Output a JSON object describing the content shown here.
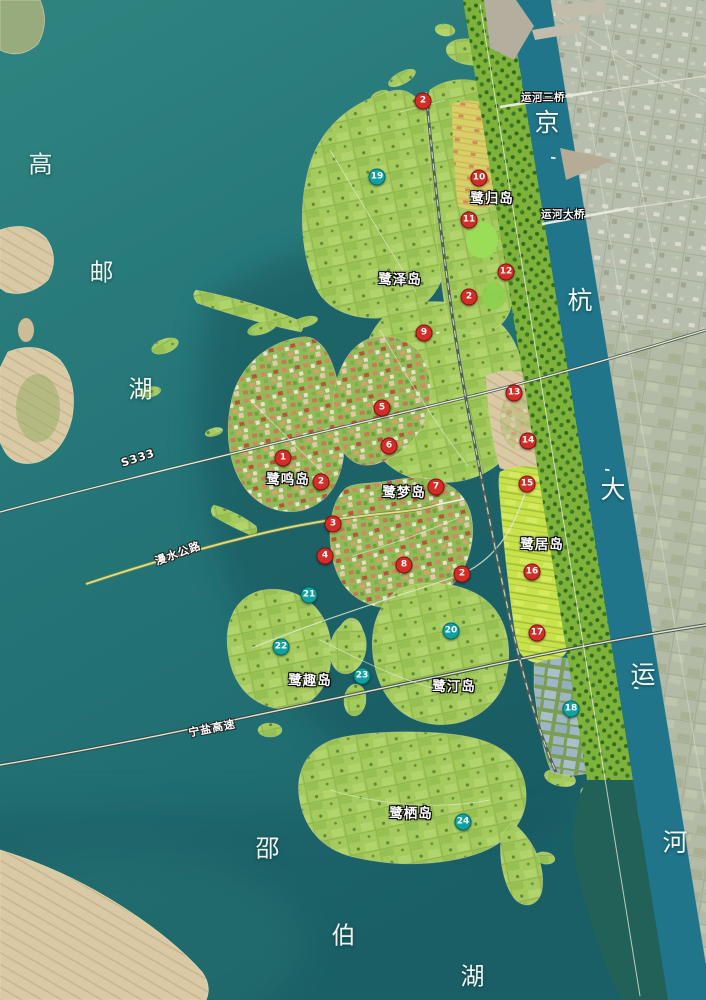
{
  "colors": {
    "lake": "#27787a",
    "lake_deep": "#14525a",
    "canal": "#20758a",
    "island_green": "#a5cb5f",
    "belt_green": "#7fb23b",
    "city_land": "#b8bead",
    "farm_land": "#b3bba6",
    "tan_flat": "#d9c9a4",
    "bright_fields": "#c9e24b",
    "marker_red": "#d22d26",
    "marker_teal": "#11a1a1",
    "label_white": "#ffffff"
  },
  "lakes": [
    {
      "id": "gaoyou",
      "chars": [
        {
          "t": "高",
          "x": 41,
          "y": 162
        },
        {
          "t": "邮",
          "x": 102,
          "y": 270
        },
        {
          "t": "湖",
          "x": 141,
          "y": 387
        }
      ]
    },
    {
      "id": "shaobo",
      "chars": [
        {
          "t": "邵",
          "x": 268,
          "y": 846
        },
        {
          "t": "伯",
          "x": 344,
          "y": 933
        },
        {
          "t": "湖",
          "x": 473,
          "y": 974
        }
      ]
    }
  ],
  "canal": {
    "chars": [
      {
        "t": "京",
        "x": 547,
        "y": 121
      },
      {
        "t": "杭",
        "x": 580,
        "y": 299
      },
      {
        "t": "大",
        "x": 613,
        "y": 488
      },
      {
        "t": "运",
        "x": 643,
        "y": 673
      },
      {
        "t": "河",
        "x": 675,
        "y": 841
      }
    ]
  },
  "islands": [
    {
      "label": "鹭归岛",
      "x": 492,
      "y": 197
    },
    {
      "label": "鹭泽岛",
      "x": 400,
      "y": 278
    },
    {
      "label": "鹭鸣岛",
      "x": 288,
      "y": 478
    },
    {
      "label": "鹭梦岛",
      "x": 404,
      "y": 491
    },
    {
      "label": "鹭居岛",
      "x": 542,
      "y": 543
    },
    {
      "label": "鹭趣岛",
      "x": 310,
      "y": 679
    },
    {
      "label": "鹭汀岛",
      "x": 454,
      "y": 685
    },
    {
      "label": "鹭栖岛",
      "x": 411,
      "y": 812
    }
  ],
  "bridges": [
    {
      "label": "运河三桥",
      "x": 543,
      "y": 97
    },
    {
      "label": "运河大桥",
      "x": 563,
      "y": 214
    }
  ],
  "roads": [
    {
      "label": "S333",
      "x": 138,
      "y": 458,
      "angle": -18
    },
    {
      "label": "漫水公路",
      "x": 178,
      "y": 553,
      "angle": -20
    },
    {
      "label": "宁盐高速",
      "x": 212,
      "y": 728,
      "angle": -11
    }
  ],
  "markers": {
    "red": [
      {
        "n": "1",
        "x": 283,
        "y": 458
      },
      {
        "n": "2",
        "x": 423,
        "y": 101
      },
      {
        "n": "2",
        "x": 469,
        "y": 297
      },
      {
        "n": "2",
        "x": 321,
        "y": 482
      },
      {
        "n": "2",
        "x": 462,
        "y": 574
      },
      {
        "n": "3",
        "x": 333,
        "y": 524
      },
      {
        "n": "4",
        "x": 325,
        "y": 556
      },
      {
        "n": "5",
        "x": 382,
        "y": 408
      },
      {
        "n": "6",
        "x": 389,
        "y": 446
      },
      {
        "n": "7",
        "x": 436,
        "y": 487
      },
      {
        "n": "8",
        "x": 404,
        "y": 565
      },
      {
        "n": "9",
        "x": 424,
        "y": 333
      },
      {
        "n": "10",
        "x": 479,
        "y": 178
      },
      {
        "n": "11",
        "x": 469,
        "y": 220
      },
      {
        "n": "12",
        "x": 506,
        "y": 272
      },
      {
        "n": "13",
        "x": 514,
        "y": 393
      },
      {
        "n": "14",
        "x": 528,
        "y": 441
      },
      {
        "n": "15",
        "x": 527,
        "y": 484
      },
      {
        "n": "16",
        "x": 532,
        "y": 572
      },
      {
        "n": "17",
        "x": 537,
        "y": 633
      }
    ],
    "teal": [
      {
        "n": "18",
        "x": 571,
        "y": 709
      },
      {
        "n": "19",
        "x": 377,
        "y": 177
      },
      {
        "n": "20",
        "x": 451,
        "y": 631
      },
      {
        "n": "21",
        "x": 309,
        "y": 595
      },
      {
        "n": "22",
        "x": 281,
        "y": 647
      },
      {
        "n": "23",
        "x": 362,
        "y": 676
      },
      {
        "n": "24",
        "x": 463,
        "y": 822
      }
    ]
  }
}
